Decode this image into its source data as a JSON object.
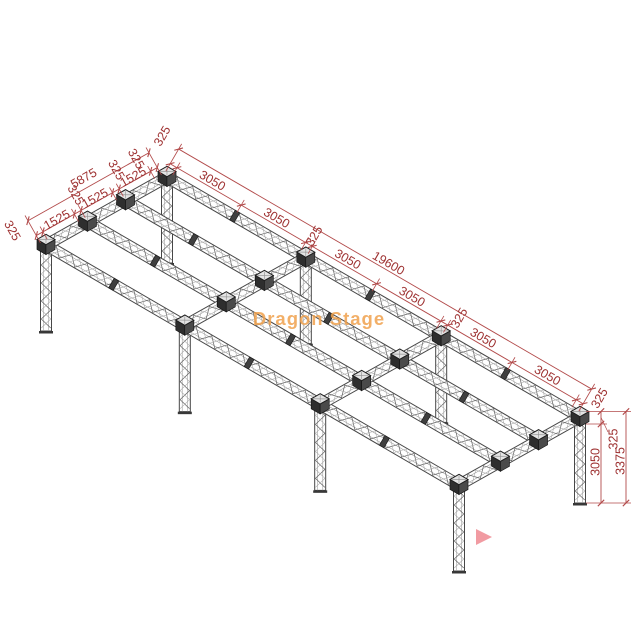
{
  "title": "truss-ground-support-frame-drawing",
  "watermark": {
    "text": "Dragon Stage",
    "color": "#F0A24E"
  },
  "cursor": {
    "color": "#F19BA2",
    "shape": "play-triangle"
  },
  "dimensions": {
    "line_color": "#B24A4A",
    "text_color": "#9E3232",
    "long_side": {
      "total": "19600",
      "bays": [
        "3050",
        "3050",
        "3050",
        "3050",
        "3050",
        "3050"
      ],
      "nodes": [
        "325",
        "325",
        "325",
        "325"
      ],
      "total_mm": 19600,
      "bay_centers_mm": [
        1850,
        4900,
        8275,
        11325,
        14700,
        17750
      ],
      "node_centers_mm": [
        162.5,
        6587.5,
        13012.5,
        19437.5
      ],
      "boundaries_mm": [
        0,
        325,
        3375,
        6425,
        6750,
        9800,
        12850,
        13175,
        16225,
        19275,
        19600
      ]
    },
    "short_side": {
      "total": "5875",
      "bays": [
        "1525",
        "1525",
        "1525"
      ],
      "nodes": [
        "325",
        "325",
        "325",
        "325"
      ],
      "total_mm": 5875,
      "bay_centers_mm": [
        1087.5,
        2937.5,
        4787.5
      ],
      "node_centers_mm": [
        162.5,
        2012.5,
        3862.5,
        5712.5
      ],
      "boundaries_mm": [
        0,
        325,
        1850,
        2175,
        3700,
        4025,
        5550,
        5875
      ]
    },
    "vertical": {
      "node": "325",
      "leg": "3050",
      "total": "3375"
    }
  },
  "structure": {
    "back_left": [
      167,
      177
    ],
    "long_vec": [
      413,
      240
    ],
    "short_vec": [
      -121,
      68
    ],
    "long_fractions": [
      0,
      0.3361,
      0.6639,
      1
    ],
    "short_fractions": [
      0,
      0.3425,
      0.6574,
      1
    ],
    "joint_mm": [
      3375,
      9800,
      16225
    ],
    "leg_drop": 86,
    "half_width": 5.5
  }
}
